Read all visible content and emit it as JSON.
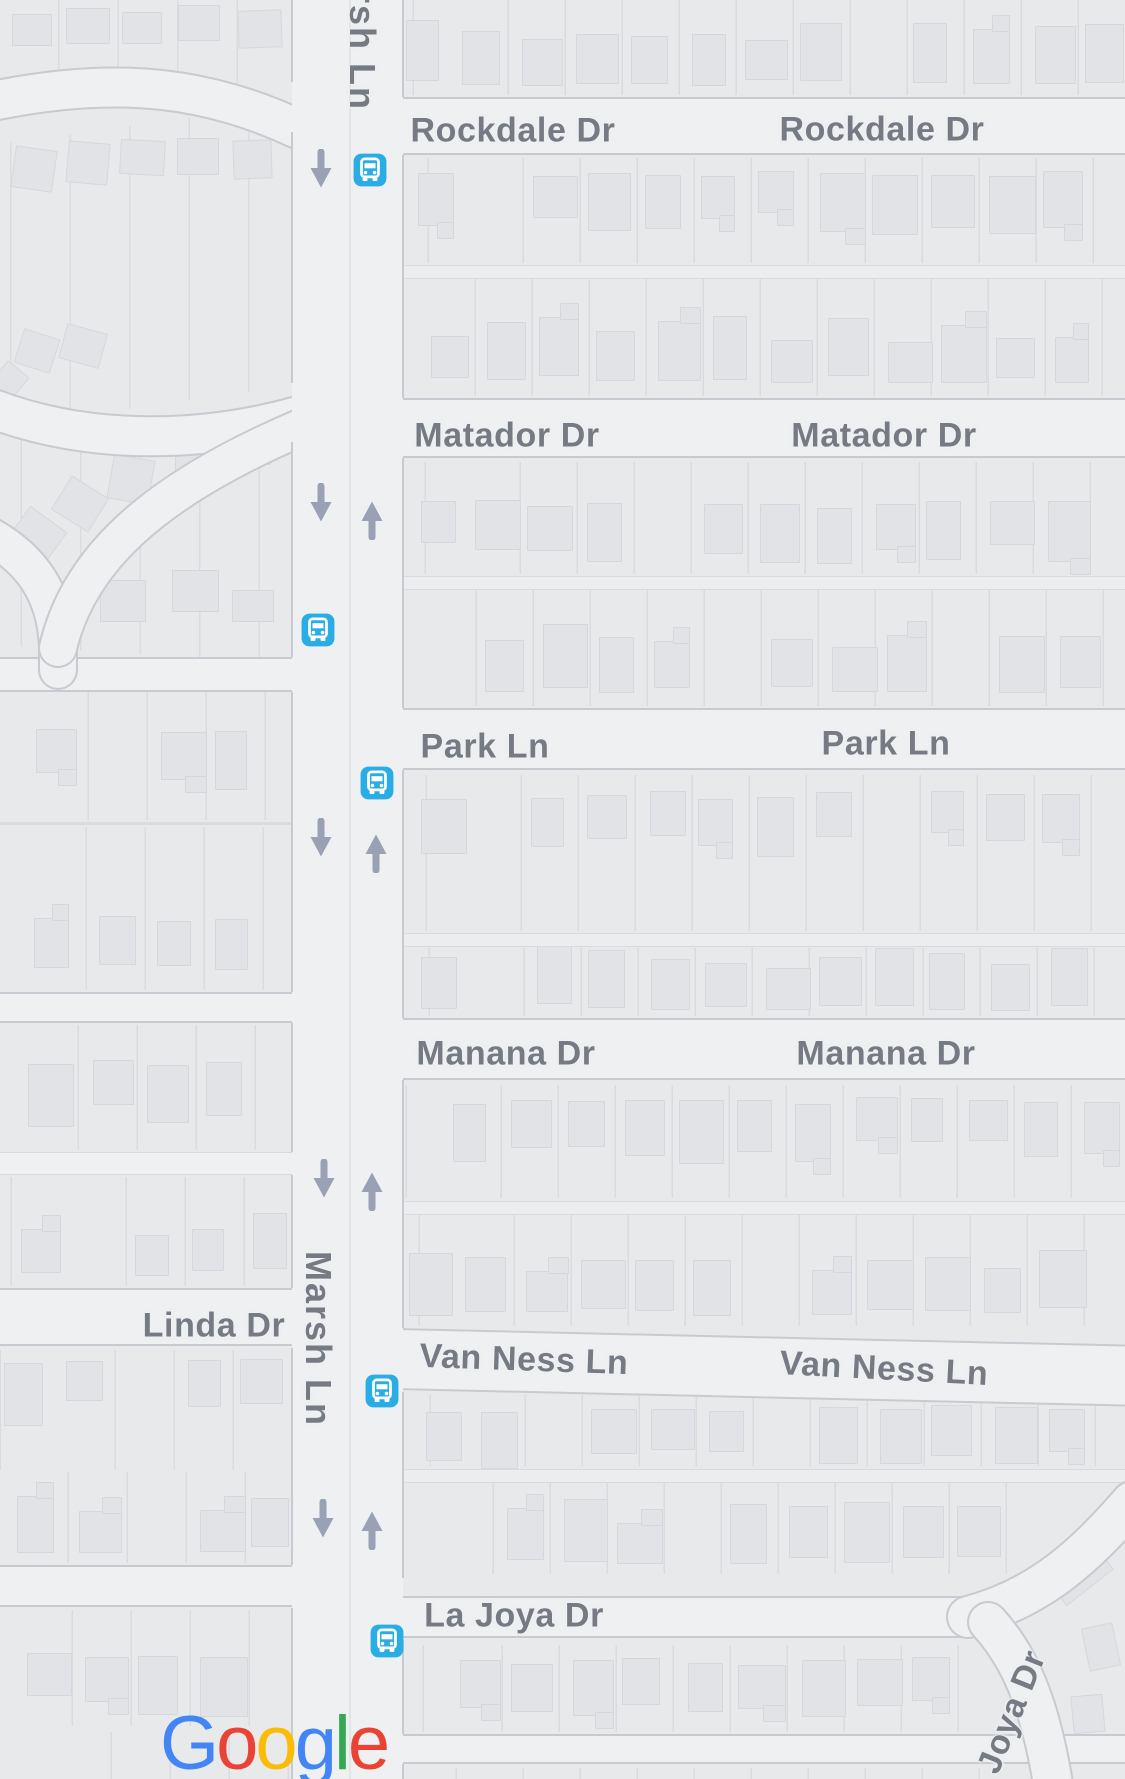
{
  "app": "map-view",
  "colors": {
    "bg": "#e8e9eb",
    "road": "#eef0f1",
    "casing": "#c7cad0",
    "parcel_line": "#d9dbdf",
    "building": "#e1e3e6",
    "building_edge": "rgba(203,206,212,0.55)",
    "label": "#757a83",
    "arrow": "#9aa1b5",
    "bus_blue": "#29ade4",
    "lane": "#ecedef",
    "centerline": "#e2e4e7",
    "logo_blue": "#4285F4",
    "logo_red": "#EA4335",
    "logo_yellow": "#FBBC05",
    "logo_green": "#34A853"
  },
  "streets": [
    {
      "name": "Rockdale Dr",
      "labels": [
        {
          "x": 513,
          "y": 131,
          "rot": 0
        },
        {
          "x": 882,
          "y": 130,
          "rot": 0
        }
      ]
    },
    {
      "name": "Matador Dr",
      "labels": [
        {
          "x": 507,
          "y": 436,
          "rot": 0
        },
        {
          "x": 884,
          "y": 436,
          "rot": 0
        }
      ]
    },
    {
      "name": "Park Ln",
      "labels": [
        {
          "x": 485,
          "y": 747,
          "rot": 0
        },
        {
          "x": 886,
          "y": 744,
          "rot": 0
        }
      ]
    },
    {
      "name": "Manana Dr",
      "labels": [
        {
          "x": 506,
          "y": 1054,
          "rot": 0
        },
        {
          "x": 886,
          "y": 1054,
          "rot": 0
        }
      ]
    },
    {
      "name": "Linda Dr",
      "labels": [
        {
          "x": 214,
          "y": 1326,
          "rot": 0
        }
      ]
    },
    {
      "name": "Van Ness Ln",
      "labels": [
        {
          "x": 524,
          "y": 1360,
          "rot": 2
        },
        {
          "x": 884,
          "y": 1369,
          "rot": 3
        }
      ]
    },
    {
      "name": "La Joya Dr",
      "labels": [
        {
          "x": 514,
          "y": 1616,
          "rot": 0
        }
      ]
    },
    {
      "name": "Marsh Ln",
      "labels": [
        {
          "x": 318,
          "y": 1339,
          "rot": 90,
          "vertical": true
        }
      ]
    },
    {
      "name": "rsh Ln",
      "labels": [
        {
          "x": 362,
          "y": 50,
          "rot": 90,
          "vertical": true
        }
      ]
    },
    {
      "name": "Joya Dr",
      "labels": [
        {
          "x": 1012,
          "y": 1712,
          "rot": -68
        }
      ]
    }
  ],
  "bus_stops": [
    {
      "x": 370,
      "y": 170
    },
    {
      "x": 318,
      "y": 630
    },
    {
      "x": 377,
      "y": 783
    },
    {
      "x": 382,
      "y": 1391
    },
    {
      "x": 387,
      "y": 1641
    }
  ],
  "arrows": [
    {
      "x": 321,
      "y": 169,
      "dir": "down"
    },
    {
      "x": 321,
      "y": 503,
      "dir": "down"
    },
    {
      "x": 372,
      "y": 520,
      "dir": "up"
    },
    {
      "x": 321,
      "y": 838,
      "dir": "down"
    },
    {
      "x": 376,
      "y": 853,
      "dir": "up"
    },
    {
      "x": 324,
      "y": 1179,
      "dir": "down"
    },
    {
      "x": 372,
      "y": 1191,
      "dir": "up"
    },
    {
      "x": 323,
      "y": 1519,
      "dir": "down"
    },
    {
      "x": 372,
      "y": 1530,
      "dir": "up"
    }
  ],
  "logo": {
    "letters": [
      {
        "ch": "G",
        "color": "#4285F4"
      },
      {
        "ch": "o",
        "color": "#EA4335"
      },
      {
        "ch": "o",
        "color": "#FBBC05"
      },
      {
        "ch": "g",
        "color": "#4285F4"
      },
      {
        "ch": "l",
        "color": "#34A853"
      },
      {
        "ch": "e",
        "color": "#EA4335"
      }
    ],
    "x": 160,
    "y": 1706
  },
  "geometry": {
    "label_font_px": 34,
    "vertical_label_font_px": 36,
    "marsh": {
      "x": 292,
      "w": 111,
      "centerline_x": 349,
      "right_casing_segments": [
        [
          0,
          97
        ],
        [
          155,
          398
        ],
        [
          458,
          708
        ],
        [
          770,
          1018
        ],
        [
          1080,
          1328
        ],
        [
          1392,
          1578
        ],
        [
          1640,
          1734
        ],
        [
          1764,
          1779
        ]
      ],
      "left_casing_segments": [
        [
          0,
          82
        ],
        [
          132,
          383
        ],
        [
          442,
          657
        ],
        [
          692,
          992
        ],
        [
          1023,
          1152
        ],
        [
          1175,
          1288
        ],
        [
          1348,
          1565
        ],
        [
          1608,
          1779
        ]
      ]
    },
    "h_roads": [
      {
        "x0": 396,
        "x1": 1125,
        "y": 97,
        "h": 58
      },
      {
        "x0": 396,
        "x1": 1125,
        "y": 398,
        "h": 60
      },
      {
        "x0": 396,
        "x1": 1125,
        "y": 708,
        "h": 62
      },
      {
        "x0": 396,
        "x1": 1125,
        "y": 1018,
        "h": 62
      },
      {
        "x0": 396,
        "x1": 1130,
        "y": 1328,
        "h": 62,
        "tilt": 1.3
      },
      {
        "x0": 396,
        "x1": 985,
        "y": 1596,
        "h": 42
      },
      {
        "x0": 396,
        "x1": 1125,
        "y": 1734,
        "h": 30
      },
      {
        "x0": 0,
        "x1": 296,
        "y": 657,
        "h": 35
      },
      {
        "x0": 0,
        "x1": 296,
        "y": 992,
        "h": 31
      },
      {
        "x0": 0,
        "x1": 296,
        "y": 1152,
        "h": 23,
        "minor": true
      },
      {
        "x0": 0,
        "x1": 296,
        "y": 1288,
        "h": 58
      },
      {
        "x0": 0,
        "x1": 296,
        "y": 1565,
        "h": 42
      }
    ],
    "alleys_right": [
      265,
      576,
      933,
      1201,
      1469
    ],
    "curves": [
      {
        "d": "M -12,102 C 120,74 210,88 300,130",
        "w": 38
      },
      {
        "d": "M -12,407 C 90,447 205,442 298,416",
        "w": 38
      },
      {
        "d": "M -12,535 C 30,558 56,592 58,648 L 58,670",
        "w": 36
      },
      {
        "d": "M 58,648 C 78,562 150,492 300,428",
        "w": 36
      },
      {
        "d": "M 968,1617 C 1040,1598 1085,1556 1132,1502",
        "w": 40
      },
      {
        "d": "M 988,1622 C 1018,1655 1040,1700 1054,1790",
        "w": 38
      }
    ],
    "right_rows": [
      {
        "x0": 403,
        "x1": 1125,
        "y0": 0,
        "y1": 95,
        "face": "down",
        "off": 10
      },
      {
        "x0": 403,
        "x1": 1125,
        "y0": 158,
        "y1": 263,
        "face": "up",
        "off": 10
      },
      {
        "x0": 403,
        "x1": 1125,
        "y0": 276,
        "y1": 396,
        "face": "down",
        "off": 14
      },
      {
        "x0": 403,
        "x1": 1125,
        "y0": 462,
        "y1": 574,
        "face": "up",
        "off": 38
      },
      {
        "x0": 403,
        "x1": 1125,
        "y0": 590,
        "y1": 706,
        "face": "down",
        "off": 14
      },
      {
        "x0": 403,
        "x1": 1125,
        "y0": 775,
        "y1": 931,
        "face": "up",
        "off": 16
      },
      {
        "x0": 403,
        "x1": 1125,
        "y0": 948,
        "y1": 1016,
        "face": "down",
        "off": 6
      },
      {
        "x0": 403,
        "x1": 1125,
        "y0": 1085,
        "y1": 1198,
        "face": "up",
        "off": 12
      },
      {
        "x0": 403,
        "x1": 1125,
        "y0": 1214,
        "y1": 1326,
        "face": "down",
        "off": 12
      },
      {
        "x0": 403,
        "x1": 1125,
        "y0": 1395,
        "y1": 1466,
        "face": "up",
        "off": 10
      },
      {
        "x0": 403,
        "x1": 1010,
        "y0": 1480,
        "y1": 1574,
        "face": "down",
        "off": 12
      },
      {
        "x0": 403,
        "x1": 995,
        "y0": 1645,
        "y1": 1732,
        "face": "up",
        "off": 12
      },
      {
        "x0": 403,
        "x1": 1040,
        "y0": 1768,
        "y1": 1779,
        "face": "none",
        "off": 0
      }
    ],
    "left_rows": [
      {
        "x0": 0,
        "x1": 292,
        "y0": 692,
        "y1": 820,
        "face": "up",
        "off": 34
      },
      {
        "x0": 0,
        "x1": 292,
        "y0": 827,
        "y1": 990,
        "face": "down",
        "off": 22
      },
      {
        "x0": 0,
        "x1": 292,
        "y0": 1025,
        "y1": 1150,
        "face": "up",
        "off": 34
      },
      {
        "x0": 0,
        "x1": 292,
        "y0": 1177,
        "y1": 1286,
        "face": "down",
        "off": 12
      },
      {
        "x0": 0,
        "x1": 292,
        "y0": 1350,
        "y1": 1470,
        "face": "up",
        "off": 8
      },
      {
        "x0": 0,
        "x1": 292,
        "y0": 1472,
        "y1": 1563,
        "face": "down",
        "off": 10
      },
      {
        "x0": 0,
        "x1": 292,
        "y0": 1610,
        "y1": 1726,
        "face": "up",
        "off": 40
      },
      {
        "x0": 0,
        "x1": 292,
        "y0": 1732,
        "y1": 1779,
        "face": "none",
        "off": 0
      }
    ],
    "back_lines_left": [
      822
    ],
    "fan_strips": [
      {
        "x": -30,
        "y": 125,
        "w": 350,
        "h": 280,
        "rot": -8,
        "angle": 98
      },
      {
        "x": -30,
        "y": 430,
        "w": 350,
        "h": 225,
        "rot": 4,
        "angle": 86
      },
      {
        "x": 0,
        "y": 0,
        "w": 300,
        "h": 86,
        "rot": 0,
        "angle": 90
      }
    ],
    "scatter_buildings": [
      {
        "x": 12,
        "y": 14,
        "w": 38,
        "h": 30,
        "rot": 0
      },
      {
        "x": 66,
        "y": 8,
        "w": 42,
        "h": 34,
        "rot": 0
      },
      {
        "x": 122,
        "y": 12,
        "w": 38,
        "h": 30,
        "rot": 0
      },
      {
        "x": 178,
        "y": 5,
        "w": 40,
        "h": 34,
        "rot": 0
      },
      {
        "x": 238,
        "y": 10,
        "w": 42,
        "h": 36,
        "rot": -2
      },
      {
        "x": 13,
        "y": 148,
        "w": 40,
        "h": 40,
        "rot": 8
      },
      {
        "x": 67,
        "y": 142,
        "w": 40,
        "h": 40,
        "rot": 5
      },
      {
        "x": 120,
        "y": 140,
        "w": 43,
        "h": 33,
        "rot": 3
      },
      {
        "x": 177,
        "y": 138,
        "w": 40,
        "h": 35,
        "rot": 0
      },
      {
        "x": 233,
        "y": 140,
        "w": 37,
        "h": 37,
        "rot": -2
      },
      {
        "x": 62,
        "y": 328,
        "w": 40,
        "h": 34,
        "rot": 15
      },
      {
        "x": 18,
        "y": 333,
        "w": 36,
        "h": 34,
        "rot": 18
      },
      {
        "x": -6,
        "y": 365,
        "w": 26,
        "h": 32,
        "rot": 40
      },
      {
        "x": 110,
        "y": 457,
        "w": 40,
        "h": 43,
        "rot": 10
      },
      {
        "x": 175,
        "y": 437,
        "w": 48,
        "h": 33,
        "rot": 0
      },
      {
        "x": 235,
        "y": 433,
        "w": 34,
        "h": 30,
        "rot": 0
      },
      {
        "x": 58,
        "y": 484,
        "w": 42,
        "h": 38,
        "rot": 32
      },
      {
        "x": 13,
        "y": 515,
        "w": 44,
        "h": 42,
        "rot": 36
      },
      {
        "x": 100,
        "y": 580,
        "w": 44,
        "h": 40,
        "rot": 0
      },
      {
        "x": 172,
        "y": 570,
        "w": 45,
        "h": 40,
        "rot": 0
      },
      {
        "x": 232,
        "y": 590,
        "w": 40,
        "h": 30,
        "rot": 0
      },
      {
        "x": 1048,
        "y": 1552,
        "w": 58,
        "h": 38,
        "rot": -38
      },
      {
        "x": 1085,
        "y": 1625,
        "w": 30,
        "h": 42,
        "rot": -12
      },
      {
        "x": 1072,
        "y": 1695,
        "w": 30,
        "h": 36,
        "rot": -5
      }
    ]
  }
}
